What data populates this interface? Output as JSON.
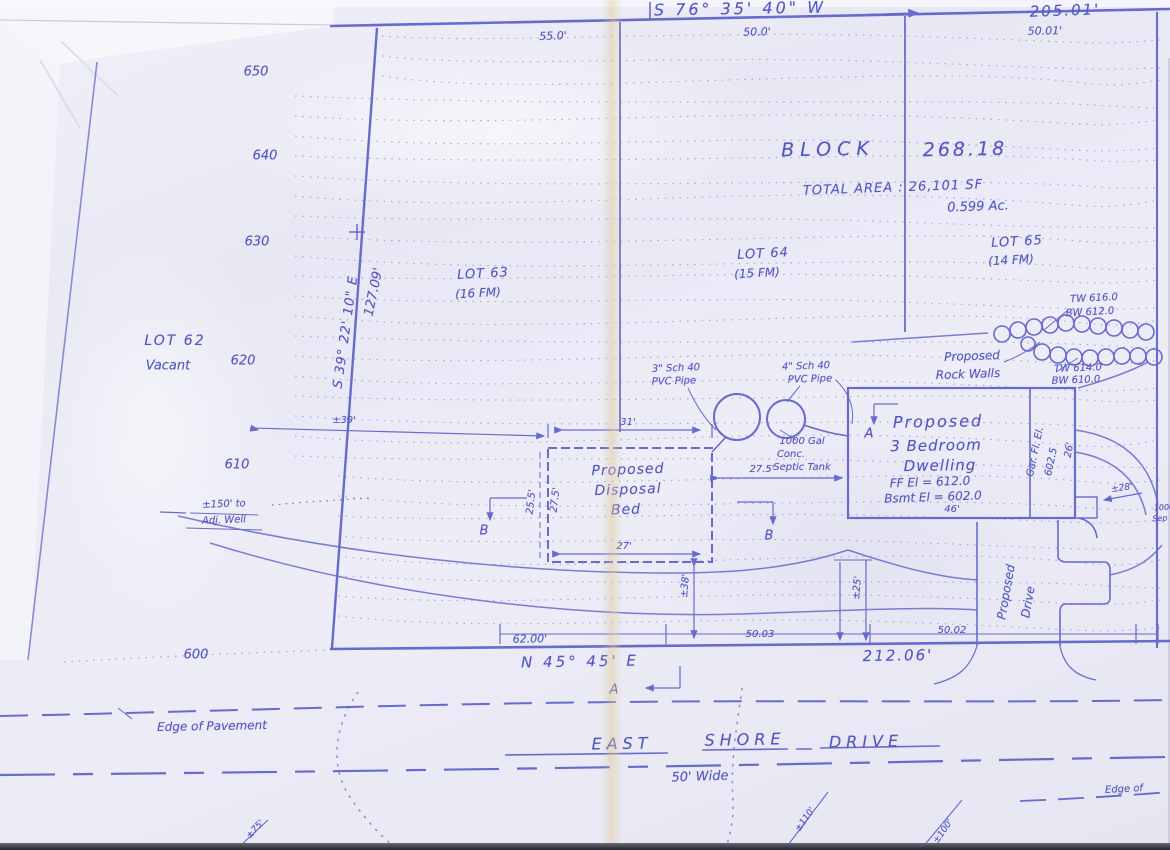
{
  "colors": {
    "ink": "#5257c0",
    "ink_line": "#666bcc",
    "ink_dots": "#989bdc",
    "paper": "#e9e9f4",
    "crease": "#d8c289"
  },
  "labels": [
    {
      "n": "bearing-rear-line",
      "t": "S 76° 35' 40\" W",
      "x": 740,
      "y": 9,
      "s": 16,
      "r": -1,
      "ls": 3
    },
    {
      "n": "distance-rear-line",
      "t": "205.01'",
      "x": 1065,
      "y": 11,
      "s": 15,
      "r": -2,
      "ls": 2
    },
    {
      "n": "rear-width-lot63",
      "t": "55.0'",
      "x": 553,
      "y": 36,
      "s": 11,
      "r": -2
    },
    {
      "n": "rear-width-lot64",
      "t": "50.0'",
      "x": 757,
      "y": 32,
      "s": 11,
      "r": -1
    },
    {
      "n": "rear-width-lot65",
      "t": "50.01'",
      "x": 1045,
      "y": 31,
      "s": 11,
      "r": -1
    },
    {
      "n": "contour-650",
      "t": "650",
      "x": 256,
      "y": 72,
      "s": 13
    },
    {
      "n": "contour-640",
      "t": "640",
      "x": 265,
      "y": 156,
      "s": 13
    },
    {
      "n": "contour-630",
      "t": "630",
      "x": 257,
      "y": 242,
      "s": 13
    },
    {
      "n": "contour-620",
      "t": "620",
      "x": 243,
      "y": 361,
      "s": 13
    },
    {
      "n": "contour-610",
      "t": "610",
      "x": 237,
      "y": 465,
      "s": 13
    },
    {
      "n": "contour-600",
      "t": "600",
      "x": 196,
      "y": 655,
      "s": 13
    },
    {
      "n": "lot62-label",
      "t": "LOT 62",
      "x": 175,
      "y": 341,
      "s": 14,
      "ls": 2
    },
    {
      "n": "lot62-status",
      "t": "Vacant",
      "x": 168,
      "y": 366,
      "s": 13
    },
    {
      "n": "bearing-left-line",
      "t": "S 39° 22' 10\" E",
      "x": 346,
      "y": 332,
      "s": 13,
      "r": -82,
      "ls": 1
    },
    {
      "n": "distance-left-line",
      "t": "127.09'",
      "x": 374,
      "y": 292,
      "s": 13,
      "r": -78
    },
    {
      "n": "lot63-label",
      "t": "LOT 63",
      "x": 483,
      "y": 274,
      "s": 13,
      "r": -3,
      "ls": 1
    },
    {
      "n": "lot63-fm",
      "t": "(16 FM)",
      "x": 478,
      "y": 293,
      "s": 12,
      "r": -3
    },
    {
      "n": "lot64-label",
      "t": "LOT 64",
      "x": 763,
      "y": 254,
      "s": 13,
      "r": -3,
      "ls": 1
    },
    {
      "n": "lot64-fm",
      "t": "(15 FM)",
      "x": 757,
      "y": 273,
      "s": 12,
      "r": -3
    },
    {
      "n": "lot65-label",
      "t": "LOT 65",
      "x": 1017,
      "y": 242,
      "s": 13,
      "r": -3,
      "ls": 1
    },
    {
      "n": "lot65-fm",
      "t": "(14 FM)",
      "x": 1011,
      "y": 260,
      "s": 12,
      "r": -3
    },
    {
      "n": "block-word",
      "t": "BLOCK",
      "x": 828,
      "y": 150,
      "s": 19,
      "r": -1,
      "ls": 6
    },
    {
      "n": "block-number",
      "t": "268.18",
      "x": 965,
      "y": 150,
      "s": 19,
      "r": -1,
      "ls": 3
    },
    {
      "n": "total-area",
      "t": "TOTAL AREA : 26,101 SF",
      "x": 893,
      "y": 188,
      "s": 13,
      "r": -2,
      "ls": 1
    },
    {
      "n": "total-acres",
      "t": "0.599 Ac.",
      "x": 978,
      "y": 207,
      "s": 13,
      "r": -2
    },
    {
      "n": "rock-walls-label-1",
      "t": "Proposed",
      "x": 972,
      "y": 356,
      "s": 12,
      "r": -2
    },
    {
      "n": "rock-walls-label-2",
      "t": "Rock Walls",
      "x": 968,
      "y": 374,
      "s": 12,
      "r": -2
    },
    {
      "n": "wall1-top",
      "t": "TW 616.0",
      "x": 1094,
      "y": 299,
      "s": 10,
      "r": -3
    },
    {
      "n": "wall1-bottom",
      "t": "BW 612.0",
      "x": 1090,
      "y": 313,
      "s": 10,
      "r": -3
    },
    {
      "n": "wall2-top",
      "t": "TW 614.0",
      "x": 1078,
      "y": 369,
      "s": 10,
      "r": -2
    },
    {
      "n": "wall2-bottom",
      "t": "BW 610.0",
      "x": 1076,
      "y": 381,
      "s": 10,
      "r": -2
    },
    {
      "n": "pipe3-label-1",
      "t": "3\" Sch 40",
      "x": 676,
      "y": 369,
      "s": 10,
      "r": -2
    },
    {
      "n": "pipe3-label-2",
      "t": "PVC Pipe",
      "x": 674,
      "y": 382,
      "s": 10,
      "r": -2
    },
    {
      "n": "pipe4-label-1",
      "t": "4\" Sch 40",
      "x": 806,
      "y": 367,
      "s": 10,
      "r": -2
    },
    {
      "n": "pipe4-label-2",
      "t": "PVC Pipe",
      "x": 810,
      "y": 380,
      "s": 10,
      "r": -2
    },
    {
      "n": "septic-label-1",
      "t": "1000 Gal",
      "x": 802,
      "y": 442,
      "s": 10
    },
    {
      "n": "septic-label-2",
      "t": "Conc.",
      "x": 791,
      "y": 455,
      "s": 10
    },
    {
      "n": "septic-label-3",
      "t": "Septic Tank",
      "x": 802,
      "y": 468,
      "s": 10
    },
    {
      "n": "dim-39",
      "t": "±39'",
      "x": 344,
      "y": 421,
      "s": 10
    },
    {
      "n": "dim-31",
      "t": "31'",
      "x": 628,
      "y": 423,
      "s": 10
    },
    {
      "n": "dim-25-5",
      "t": "25.5'",
      "x": 532,
      "y": 502,
      "s": 10,
      "r": -83
    },
    {
      "n": "dim-27-5-left",
      "t": "27.5'",
      "x": 556,
      "y": 500,
      "s": 10,
      "r": -83
    },
    {
      "n": "disposal-bed-1",
      "t": "Proposed",
      "x": 628,
      "y": 470,
      "s": 14,
      "r": -2,
      "ls": 1
    },
    {
      "n": "disposal-bed-2",
      "t": "Disposal",
      "x": 628,
      "y": 490,
      "s": 14,
      "r": -2,
      "ls": 1
    },
    {
      "n": "disposal-bed-3",
      "t": "Bed",
      "x": 626,
      "y": 510,
      "s": 14,
      "r": -2,
      "ls": 1
    },
    {
      "n": "dim-27-5-right",
      "t": "27.5'",
      "x": 762,
      "y": 470,
      "s": 10
    },
    {
      "n": "dim-27",
      "t": "27'",
      "x": 624,
      "y": 547,
      "s": 10
    },
    {
      "n": "section-b-left",
      "t": "B",
      "x": 484,
      "y": 531,
      "s": 13
    },
    {
      "n": "section-b-right",
      "t": "B",
      "x": 769,
      "y": 536,
      "s": 13
    },
    {
      "n": "section-a-top",
      "t": "A",
      "x": 869,
      "y": 434,
      "s": 13
    },
    {
      "n": "dwelling-1",
      "t": "Proposed",
      "x": 938,
      "y": 422,
      "s": 16,
      "r": -1,
      "ls": 2
    },
    {
      "n": "dwelling-2",
      "t": "3 Bedroom",
      "x": 936,
      "y": 446,
      "s": 15,
      "r": -1,
      "ls": 1
    },
    {
      "n": "dwelling-3",
      "t": "Dwelling",
      "x": 940,
      "y": 466,
      "s": 15,
      "r": -1,
      "ls": 1
    },
    {
      "n": "dwelling-ff-el",
      "t": "FF El = 612.0",
      "x": 930,
      "y": 482,
      "s": 12,
      "r": -2
    },
    {
      "n": "dwelling-bsmt-el",
      "t": "Bsmt El = 602.0",
      "x": 933,
      "y": 497,
      "s": 12,
      "r": -2
    },
    {
      "n": "dim-46",
      "t": "46'",
      "x": 952,
      "y": 510,
      "s": 10
    },
    {
      "n": "garage-el-1",
      "t": "Gar. Fl. El.",
      "x": 1036,
      "y": 452,
      "s": 10,
      "r": -78
    },
    {
      "n": "garage-el-2",
      "t": "602.5",
      "x": 1052,
      "y": 462,
      "s": 10,
      "r": -78
    },
    {
      "n": "dim-26",
      "t": "26'",
      "x": 1070,
      "y": 450,
      "s": 10,
      "r": -80
    },
    {
      "n": "dim-28",
      "t": "±28'",
      "x": 1122,
      "y": 489,
      "s": 9,
      "r": -8
    },
    {
      "n": "edge-fragment-1000",
      "t": "1000",
      "x": 1164,
      "y": 508,
      "s": 8,
      "r": -3
    },
    {
      "n": "edge-fragment-sep",
      "t": "Sep",
      "x": 1160,
      "y": 519,
      "s": 8,
      "r": -3
    },
    {
      "n": "dim-25",
      "t": "±25'",
      "x": 858,
      "y": 588,
      "s": 10,
      "r": -85
    },
    {
      "n": "dim-38",
      "t": "±38'",
      "x": 686,
      "y": 586,
      "s": 10,
      "r": -85
    },
    {
      "n": "proposed-drive-1",
      "t": "Proposed",
      "x": 1006,
      "y": 592,
      "s": 12,
      "r": -80
    },
    {
      "n": "proposed-drive-2",
      "t": "Drive",
      "x": 1028,
      "y": 602,
      "s": 12,
      "r": -80
    },
    {
      "n": "front-width-lot63",
      "t": "62.00'",
      "x": 530,
      "y": 639,
      "s": 11,
      "r": -1
    },
    {
      "n": "front-width-lot64",
      "t": "50.03",
      "x": 760,
      "y": 635,
      "s": 10
    },
    {
      "n": "front-width-lot65",
      "t": "50.02",
      "x": 952,
      "y": 631,
      "s": 10
    },
    {
      "n": "bearing-front-line",
      "t": "N 45° 45' E",
      "x": 580,
      "y": 662,
      "s": 15,
      "r": -1,
      "ls": 3
    },
    {
      "n": "distance-front-line",
      "t": "212.06'",
      "x": 898,
      "y": 656,
      "s": 15,
      "r": -1,
      "ls": 2
    },
    {
      "n": "section-a-bottom",
      "t": "A",
      "x": 614,
      "y": 690,
      "s": 13
    },
    {
      "n": "edge-of-pavement",
      "t": "Edge of Pavement",
      "x": 212,
      "y": 726,
      "s": 12,
      "r": -1
    },
    {
      "n": "road-name-east",
      "t": "EAST",
      "x": 622,
      "y": 744,
      "s": 16,
      "r": -1,
      "ls": 5
    },
    {
      "n": "road-name-shore",
      "t": "SHORE",
      "x": 745,
      "y": 740,
      "s": 16,
      "r": -1,
      "ls": 5
    },
    {
      "n": "road-name-drive",
      "t": "DRIVE",
      "x": 866,
      "y": 742,
      "s": 16,
      "r": -1,
      "ls": 5
    },
    {
      "n": "road-width",
      "t": "50' Wide",
      "x": 700,
      "y": 777,
      "s": 13,
      "r": -2
    },
    {
      "n": "edge-of-pavement-right",
      "t": "Edge of",
      "x": 1124,
      "y": 790,
      "s": 10,
      "r": -3
    },
    {
      "n": "well-distance-1",
      "t": "±150' to",
      "x": 224,
      "y": 505,
      "s": 10,
      "r": -2
    },
    {
      "n": "well-distance-2",
      "t": "Adj. Well",
      "x": 224,
      "y": 521,
      "s": 10,
      "r": -2
    },
    {
      "n": "bottom-note-left",
      "t": "±75'",
      "x": 256,
      "y": 830,
      "s": 9,
      "r": -48
    },
    {
      "n": "bottom-note-mid",
      "t": "±110'",
      "x": 806,
      "y": 820,
      "s": 9,
      "r": -55
    },
    {
      "n": "bottom-note-right",
      "t": "±100'",
      "x": 944,
      "y": 832,
      "s": 9,
      "r": -55
    }
  ]
}
